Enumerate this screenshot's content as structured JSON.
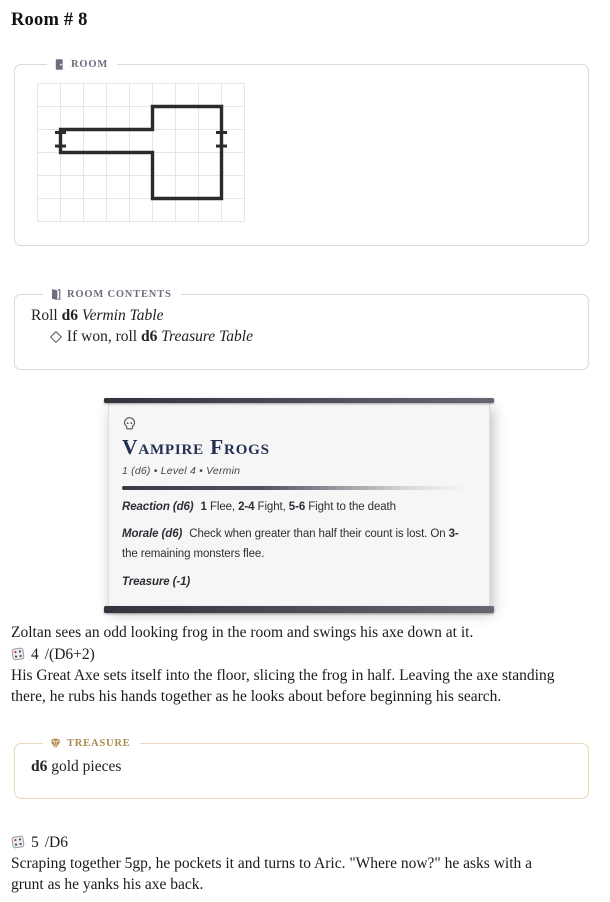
{
  "page": {
    "title": "Room # 8"
  },
  "colors": {
    "accent_slate": "#716d80",
    "accent_gold": "#aa8c4e",
    "panel_border": "#d9d9de",
    "treasure_border": "#e8d7b8",
    "card_title_navy": "#243053",
    "card_bar": "#34323d",
    "map_wall": "#2b2b2e",
    "map_grid": "#e6e6ea",
    "die_pip_red": "#c0392b"
  },
  "panels": {
    "room": {
      "label": "ROOM",
      "icon": "door"
    },
    "room_contents": {
      "label": "ROOM CONTENTS",
      "icon": "open-door",
      "lines": [
        {
          "segments": [
            {
              "t": "Roll "
            },
            {
              "t": "d6",
              "b": 1
            },
            {
              "t": " "
            },
            {
              "t": "Vermin Table",
              "i": 1
            }
          ]
        },
        {
          "bullet": "◇",
          "segments": [
            {
              "t": "If won, roll "
            },
            {
              "t": "d6",
              "b": 1
            },
            {
              "t": " "
            },
            {
              "t": "Treasure Table",
              "i": 1
            }
          ]
        }
      ]
    },
    "treasure": {
      "label": "TREASURE",
      "icon": "gem",
      "lines": [
        {
          "segments": [
            {
              "t": "d6",
              "b": 1
            },
            {
              "t": " gold pieces"
            }
          ]
        }
      ]
    }
  },
  "room_map": {
    "cols": 9,
    "rows": 6,
    "cell_size": 23,
    "outline": [
      [
        1,
        2
      ],
      [
        5,
        2
      ],
      [
        5,
        1
      ],
      [
        8,
        1
      ],
      [
        8,
        5
      ],
      [
        5,
        5
      ],
      [
        5,
        3
      ],
      [
        1,
        3
      ]
    ],
    "door_ticks": [
      [
        0.76,
        2.13,
        1.24,
        2.13
      ],
      [
        0.76,
        2.72,
        1.24,
        2.72
      ],
      [
        7.76,
        2.13,
        8.24,
        2.13
      ],
      [
        7.76,
        2.72,
        8.24,
        2.72
      ]
    ],
    "wall_color": "#2b2b2e",
    "grid_color": "#e6e6ea"
  },
  "monster_card": {
    "icon": "skull",
    "name": "Vampire Frogs",
    "meta": "1 (d6) • Level 4 • Vermin",
    "stats": [
      {
        "label": "Reaction (d6)",
        "segments": [
          {
            "t": "1",
            "b": 1
          },
          {
            "t": " Flee, "
          },
          {
            "t": "2-4",
            "b": 1
          },
          {
            "t": " Fight, "
          },
          {
            "t": "5-6",
            "b": 1
          },
          {
            "t": " Fight to the death"
          }
        ]
      },
      {
        "label": "Morale (d6)",
        "segments": [
          {
            "t": "Check when greater than half their count is lost. On "
          },
          {
            "t": "3-",
            "b": 1
          },
          {
            "br": 1
          },
          {
            "t": "the remaining monsters flee."
          }
        ]
      },
      {
        "label": "Treasure (-1)",
        "segments": []
      }
    ]
  },
  "story": {
    "p1": {
      "segments": [
        {
          "t": "Zoltan sees an odd looking frog in the room and swings his axe down at it."
        }
      ]
    },
    "roll1": {
      "value": "4",
      "formula": "/(D6+2)",
      "icon": "die"
    },
    "p2": {
      "segments": [
        {
          "t": "His Great Axe sets itself into the floor, slicing the frog in half. Leaving the axe standing"
        },
        {
          "br": 1
        },
        {
          "t": "there, he rubs his hands together as he looks about before beginning his search."
        }
      ]
    },
    "roll2": {
      "value": "5",
      "formula": "/D6",
      "icon": "die"
    },
    "p3": {
      "segments": [
        {
          "t": "Scraping together 5gp, he pockets it and turns to Aric. \"Where now?\" he asks with a"
        },
        {
          "br": 1
        },
        {
          "t": "grunt as he yanks his axe back."
        }
      ]
    }
  }
}
